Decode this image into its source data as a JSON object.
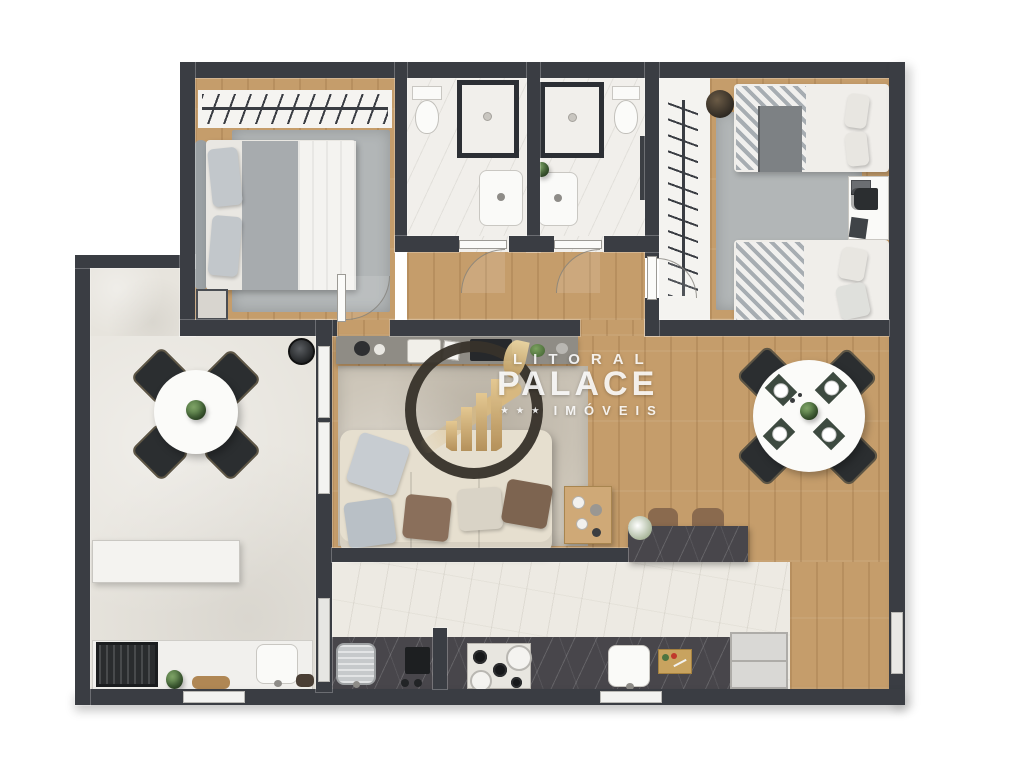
{
  "watermark": {
    "line1": "LITORAL",
    "line2": "PALACE",
    "stars": "★ ★ ★",
    "line3": "IMÓVEIS"
  },
  "colors": {
    "wall": "#3a3d43",
    "wood": "#c59d6b",
    "concrete": "#e7e4dd",
    "marble": "#edeae3",
    "tile": "#f1efeb",
    "closet_floor": "#f4f3f0",
    "rug": "#b2b6b7",
    "living_rug": "#cdc6b9",
    "counter": "#48464b",
    "sofa": "#e6dfcf",
    "green": "#4e7440",
    "chair_dark": "#2b2e30",
    "white_furn": "#fafaf8",
    "gold": "#c9a96a",
    "ring": "#37322a",
    "wm": "rgba(255,255,255,0.88)"
  },
  "floorplan": {
    "type": "apartment-floor-plan",
    "view": "3d-top-down-render",
    "rooms": [
      {
        "id": "master-bedroom",
        "furniture": [
          "double-bed",
          "wardrobe-rail",
          "rug",
          "bench"
        ]
      },
      {
        "id": "bathroom-1",
        "furniture": [
          "shower",
          "toilet",
          "vanity-sink"
        ]
      },
      {
        "id": "bathroom-2",
        "furniture": [
          "shower",
          "toilet",
          "vanity-sink",
          "towel-shelf",
          "plant"
        ]
      },
      {
        "id": "hallway",
        "furniture": [
          "doors"
        ]
      },
      {
        "id": "bedroom-2",
        "furniture": [
          "single-bed",
          "single-bed",
          "desk",
          "chair",
          "laptop",
          "plant",
          "wardrobe-rail",
          "basket",
          "rug"
        ]
      },
      {
        "id": "living-room",
        "furniture": [
          "tv-sideboard",
          "tv",
          "sofa",
          "pillows",
          "coffee-table",
          "rug"
        ]
      },
      {
        "id": "dining-area",
        "furniture": [
          "round-table",
          "chairs",
          "place-settings",
          "plant",
          "island",
          "stools"
        ]
      },
      {
        "id": "kitchen",
        "furniture": [
          "counter",
          "cooktop",
          "pots",
          "sink",
          "cutting-board",
          "oven",
          "fridge",
          "laundry-sink",
          "window"
        ]
      },
      {
        "id": "terrace",
        "furniture": [
          "round-table",
          "chairs",
          "bar-counter",
          "bar-stools",
          "bbq-grill",
          "sink",
          "plants",
          "clock",
          "bread-board"
        ]
      }
    ]
  }
}
